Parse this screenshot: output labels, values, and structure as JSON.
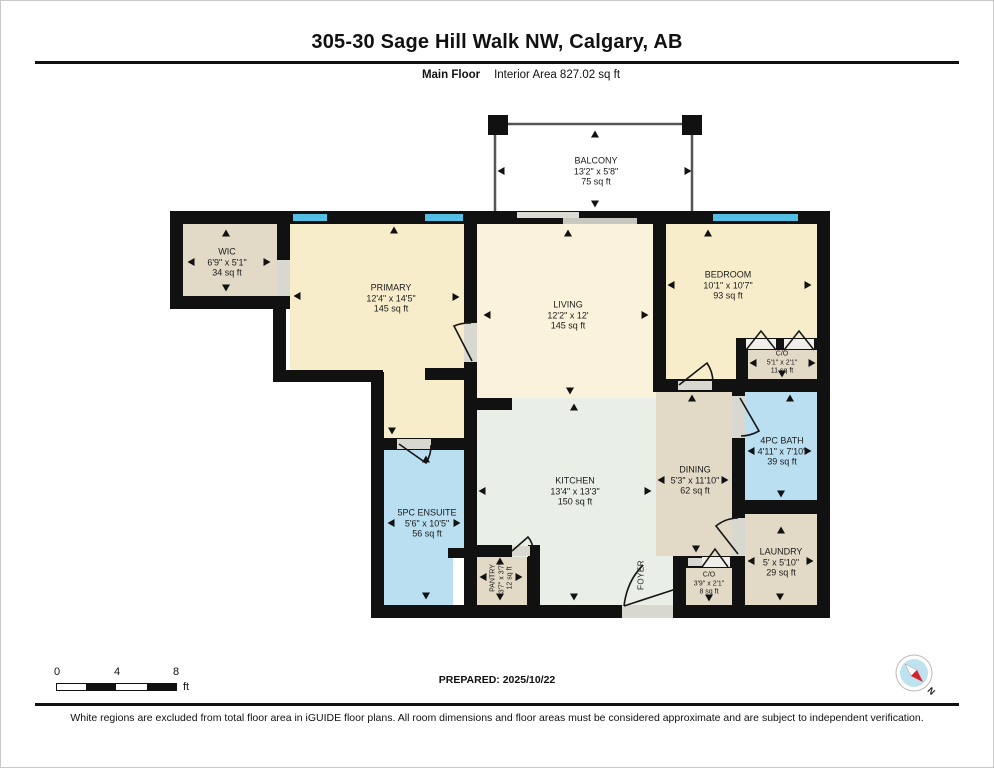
{
  "header": {
    "title": "305-30 Sage Hill Walk NW, Calgary, AB",
    "floor_label": "Main Floor",
    "area_label": "Interior Area 827.02 sq ft"
  },
  "rooms": {
    "balcony": {
      "name": "BALCONY",
      "dims": "13'2\" x 5'8\"",
      "area": "75 sq ft"
    },
    "wic": {
      "name": "WIC",
      "dims": "6'9\" x 5'1\"",
      "area": "34 sq ft"
    },
    "primary": {
      "name": "PRIMARY",
      "dims": "12'4\" x 14'5\"",
      "area": "145 sq ft"
    },
    "living": {
      "name": "LIVING",
      "dims": "12'2\" x 12'",
      "area": "145 sq ft"
    },
    "bedroom": {
      "name": "BEDROOM",
      "dims": "10'1\" x 10'7\"",
      "area": "93 sq ft"
    },
    "bedroom_closet": {
      "name": "C/O",
      "dims": "5'1\" x 2'1\"",
      "area": "11 sq ft"
    },
    "bath": {
      "name": "4PC BATH",
      "dims": "4'11\" x 7'10\"",
      "area": "39 sq ft"
    },
    "dining": {
      "name": "DINING",
      "dims": "5'3\" x 11'10\"",
      "area": "62 sq ft"
    },
    "kitchen": {
      "name": "KITCHEN",
      "dims": "13'4\" x 13'3\"",
      "area": "150 sq ft"
    },
    "ensuite": {
      "name": "5PC ENSUITE",
      "dims": "5'6\" x 10'5\"",
      "area": "56 sq ft"
    },
    "pantry": {
      "name": "PANTRY",
      "dims": "3'7\" x 3'7\"",
      "area": "12 sq ft"
    },
    "foyer": {
      "name": "FOYER"
    },
    "laundry": {
      "name": "LAUNDRY",
      "dims": "5' x 5'10\"",
      "area": "29 sq ft"
    },
    "foyer_closet": {
      "name": "C/O",
      "dims": "3'9\" x 2'1\"",
      "area": "8 sq ft"
    }
  },
  "scale_bar": {
    "tick_start": "0",
    "tick_mid": "4",
    "tick_end": "8",
    "unit": "ft"
  },
  "compass": {
    "label": "N"
  },
  "footer": {
    "prepared": "PREPARED: 2025/10/22",
    "disclaimer": "White regions are excluded from total floor area in iGUIDE floor plans. All room dimensions and floor areas must be considered approximate and are subject to independent verification."
  },
  "colors": {
    "wall": "#111111",
    "window": "#54BFE4",
    "bedroom_fill": "#F8EDCB",
    "living_fill": "#FAF2DA",
    "tan_fill": "#E2D9C6",
    "bath_fill": "#B9DFF1",
    "kitchen_fill": "#E9EFE6",
    "opening": "#D9D8D0"
  }
}
